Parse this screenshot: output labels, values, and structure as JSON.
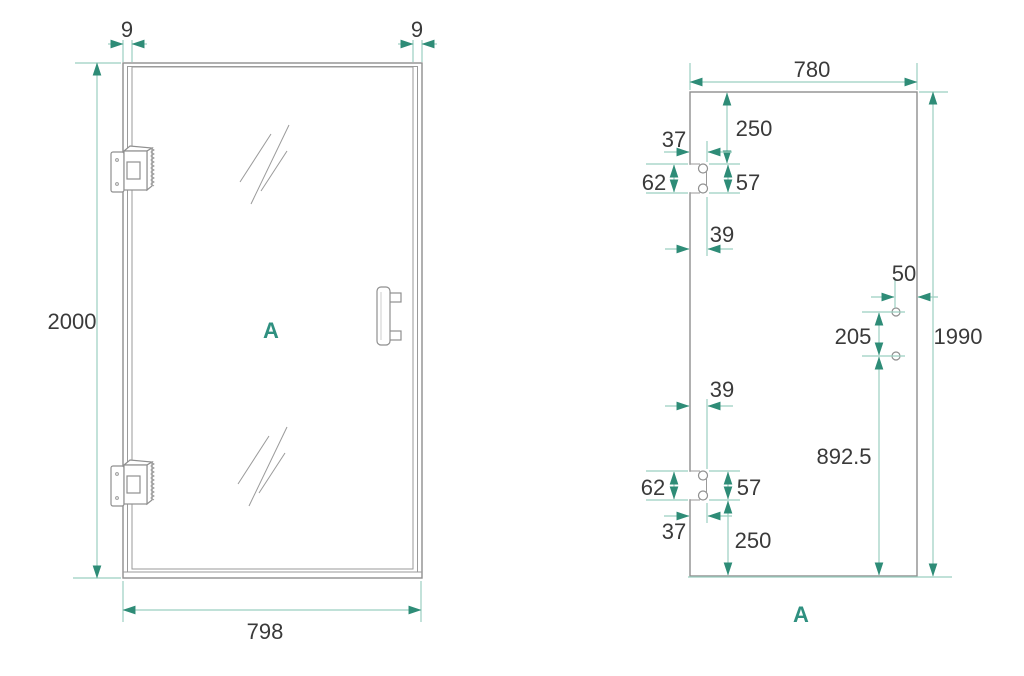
{
  "colors": {
    "background": "#ffffff",
    "object_line": "#8f8f8f",
    "dimension_line": "#9bcfc0",
    "arrow": "#2e8c77",
    "text": "#3a3a3a",
    "accent": "#2f9080"
  },
  "left_view": {
    "label": "A",
    "dims": {
      "frame_thickness_left": "9",
      "frame_thickness_right": "9",
      "door_height": "2000",
      "door_width": "798"
    }
  },
  "right_view": {
    "label": "A",
    "dims": {
      "panel_width": "780",
      "top_to_hinge_cutout": "250",
      "hinge_edge_inset_top": "37",
      "hinge_cutout_height_top": "62",
      "hinge_hole_pitch_top": "57",
      "hinge_cutout_width_top": "39",
      "handle_hole_edge_offset": "50",
      "handle_hole_pitch": "205",
      "panel_height": "1990",
      "hinge_cutout_width_bottom": "39",
      "handle_hole_from_bottom": "892.5",
      "hinge_cutout_height_bottom": "62",
      "hinge_hole_pitch_bottom": "57",
      "hinge_edge_inset_bottom": "37",
      "hinge_cutout_to_bottom": "250"
    }
  }
}
